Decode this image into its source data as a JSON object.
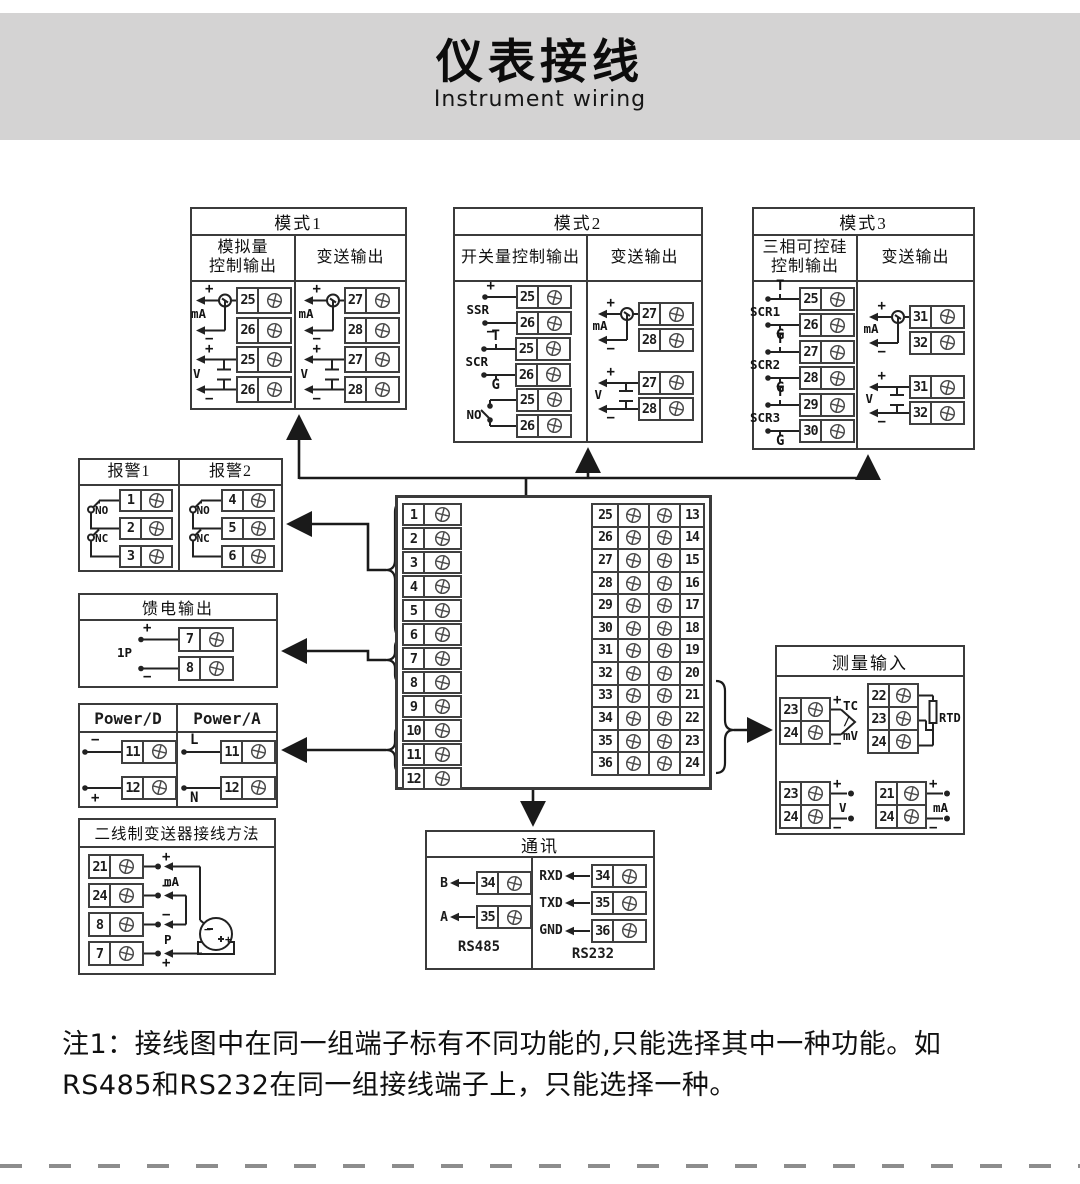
{
  "header": {
    "title_cn": "仪表接线",
    "title_en": "Instrument wiring"
  },
  "symbols": {
    "plus": "+",
    "minus": "−"
  },
  "mode1": {
    "title": "模式1",
    "col1_header": "模拟量\n控制输出",
    "col2_header": "变送输出",
    "col1": [
      {
        "type": "mA",
        "label": "mA",
        "terminals": [
          "25",
          "26"
        ]
      },
      {
        "type": "V",
        "label": "V",
        "terminals": [
          "25",
          "26"
        ]
      }
    ],
    "col2": [
      {
        "type": "mA",
        "label": "mA",
        "terminals": [
          "27",
          "28"
        ]
      },
      {
        "type": "V",
        "label": "V",
        "terminals": [
          "27",
          "28"
        ]
      }
    ]
  },
  "mode2": {
    "title": "模式2",
    "col1_header": "开关量控制输出",
    "col2_header": "变送输出",
    "col1": [
      {
        "type": "ssr",
        "label": "SSR",
        "terminals": [
          "25",
          "26"
        ]
      },
      {
        "type": "scr",
        "label": "SCR",
        "t_label": "T",
        "g_label": "G",
        "terminals": [
          "25",
          "26"
        ]
      },
      {
        "type": "no",
        "label": "NO",
        "terminals": [
          "25",
          "26"
        ]
      }
    ],
    "col2": [
      {
        "type": "mA",
        "label": "mA",
        "terminals": [
          "27",
          "28"
        ]
      },
      {
        "type": "V",
        "label": "V",
        "terminals": [
          "27",
          "28"
        ]
      }
    ]
  },
  "mode3": {
    "title": "模式3",
    "col1_header": "三相可控硅\n控制输出",
    "col2_header": "变送输出",
    "col1": [
      {
        "type": "scr",
        "label": "SCR1",
        "t_label": "T",
        "g_label": "G",
        "terminals": [
          "25",
          "26"
        ]
      },
      {
        "type": "scr",
        "label": "SCR2",
        "t_label": "T",
        "g_label": "G",
        "terminals": [
          "27",
          "28"
        ]
      },
      {
        "type": "scr",
        "label": "SCR3",
        "t_label": "T",
        "g_label": "G",
        "terminals": [
          "29",
          "30"
        ]
      }
    ],
    "col2": [
      {
        "type": "mA",
        "label": "mA",
        "terminals": [
          "31",
          "32"
        ]
      },
      {
        "type": "V",
        "label": "V",
        "terminals": [
          "31",
          "32"
        ]
      }
    ]
  },
  "alarm": {
    "col1_header": "报警1",
    "col2_header": "报警2",
    "no_label": "NO",
    "nc_label": "NC",
    "col1_terminals": [
      "1",
      "2",
      "3"
    ],
    "col2_terminals": [
      "4",
      "5",
      "6"
    ]
  },
  "feed": {
    "title": "馈电输出",
    "group": {
      "type": "feed",
      "label": "1P",
      "terminals": [
        "7",
        "8"
      ]
    }
  },
  "power": {
    "col1_header": "Power/D",
    "col2_header": "Power/A",
    "col1": {
      "type": "power",
      "top_label": "−",
      "bottom_label": "+",
      "terminals": [
        "11",
        "12"
      ]
    },
    "col2": {
      "type": "power",
      "top_label": "L",
      "bottom_label": "N",
      "terminals": [
        "11",
        "12"
      ]
    }
  },
  "twowire": {
    "title": "二线制变送器接线方法",
    "terminals": [
      "21",
      "24",
      "8",
      "7"
    ],
    "row_labels": [
      "+",
      "−",
      "−",
      "+"
    ],
    "ma_label": "mA",
    "p_label": "P",
    "tx_minus": "−",
    "tx_plus": "+"
  },
  "central": {
    "left": [
      "1",
      "2",
      "3",
      "4",
      "5",
      "6",
      "7",
      "8",
      "9",
      "10",
      "11",
      "12"
    ],
    "mid": [
      "25",
      "26",
      "27",
      "28",
      "29",
      "30",
      "31",
      "32",
      "33",
      "34",
      "35",
      "36"
    ],
    "right": [
      "13",
      "14",
      "15",
      "16",
      "17",
      "18",
      "19",
      "20",
      "21",
      "22",
      "23",
      "24"
    ]
  },
  "measure": {
    "title": "测量输入",
    "tc": {
      "terminals": [
        "23",
        "24"
      ],
      "label": "TC\n/\nmV",
      "plus": "+",
      "minus": "−"
    },
    "rtd": {
      "terminals": [
        "22",
        "23",
        "24"
      ],
      "label": "RTD"
    },
    "v": {
      "terminals": [
        "23",
        "24"
      ],
      "label": "V",
      "plus": "+",
      "minus": "−"
    },
    "ma": {
      "terminals": [
        "21",
        "24"
      ],
      "label": "mA",
      "plus": "+",
      "minus": "−"
    }
  },
  "comm": {
    "title": "通讯",
    "rs485": {
      "label": "RS485",
      "rows": [
        {
          "signal": "B",
          "terminal": "34"
        },
        {
          "signal": "A",
          "terminal": "35"
        }
      ]
    },
    "rs232": {
      "label": "RS232",
      "rows": [
        {
          "signal": "RXD",
          "terminal": "34"
        },
        {
          "signal": "TXD",
          "terminal": "35"
        },
        {
          "signal": "GND",
          "terminal": "36"
        }
      ]
    }
  },
  "note": {
    "line1": "注1：接线图中在同一组端子标有不同功能的,只能选择其中一种功能。如",
    "line2": "RS485和RS232在同一组接线端子上，只能选择一种。"
  }
}
